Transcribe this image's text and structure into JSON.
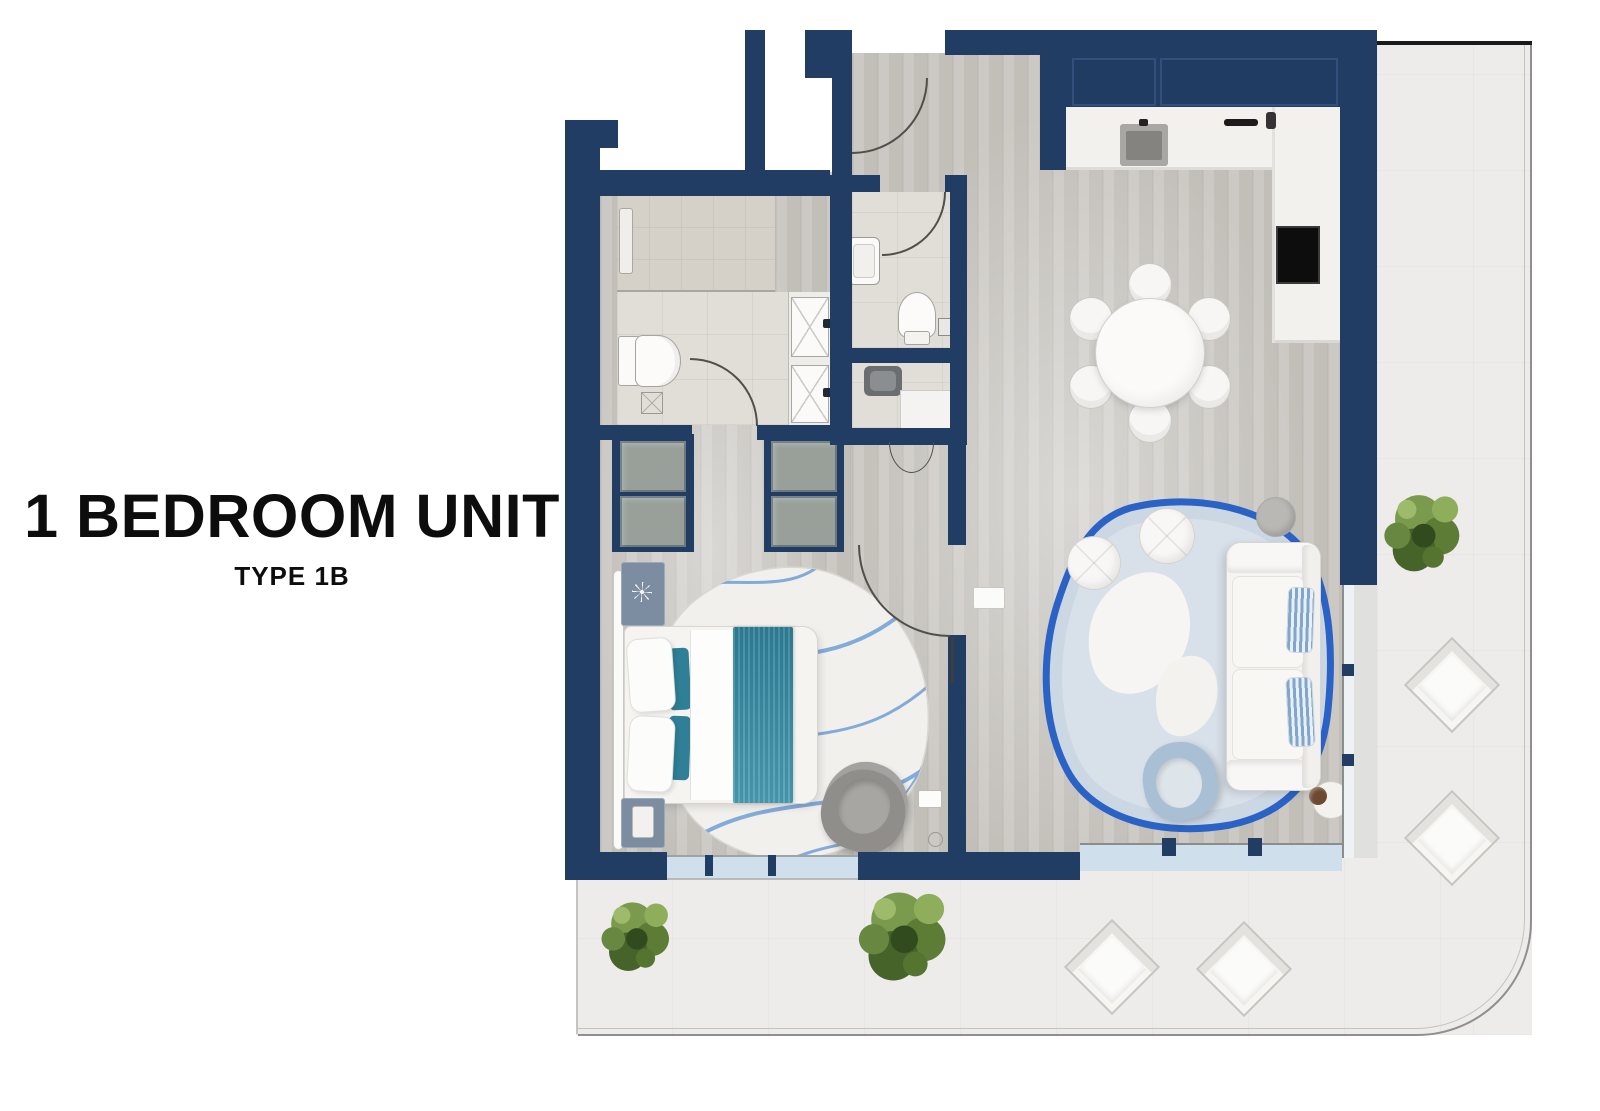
{
  "title": {
    "heading": "1 BEDROOM UNIT",
    "subtitle": "TYPE 1B"
  },
  "colors": {
    "navy": "#213d63",
    "navy2": "#2b4b77",
    "line": "#4f4f4c",
    "wood": "#c9c6c0",
    "tile": "#e1ded8",
    "shower": "#d6d1c8",
    "balcony": "#edecea",
    "glass": "#cfdfeb",
    "rail": "#8f8f8f",
    "furniture_white": "#f6f5f3",
    "teal": "#35859d",
    "rug_border_blue": "#2a62c6",
    "rug_fill": "#ccd8e4",
    "chair_blue": "#a9bfd3",
    "chair_gray": "#92918e",
    "green1": "#7a9b4e",
    "green2": "#5d7c35",
    "green3": "#46632a",
    "green4": "#8fae5c"
  }
}
